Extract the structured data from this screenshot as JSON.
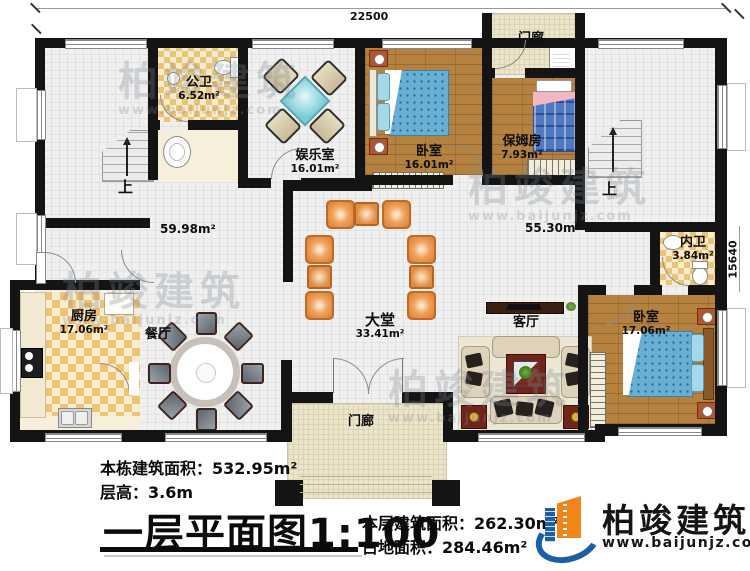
{
  "document": {
    "plan_title": "一层平面图",
    "plan_scale": "1:100",
    "stats": {
      "building_total_label": "本栋建筑面积：",
      "building_total_value": "532.95m²",
      "floor_height_label": "层高：",
      "floor_height_value": "3.6m",
      "floor_area_label": "本层建筑面积：",
      "floor_area_value": "262.30m²",
      "footprint_label": "占地面积：",
      "footprint_value": "284.46m²"
    }
  },
  "dimensions": {
    "top_width": "22500",
    "right_height": "15640"
  },
  "rooms": {
    "gongwei": {
      "name": "公卫",
      "area": "6.52m²"
    },
    "yuleshi": {
      "name": "娱乐室",
      "area": "16.01m²"
    },
    "woshi_top": {
      "name": "卧室",
      "area": "16.01m²"
    },
    "menlang_top": {
      "name": "门廊"
    },
    "baomufang": {
      "name": "保姆房",
      "area": "7.93m²"
    },
    "neiwei": {
      "name": "内卫",
      "area": "3.84m²"
    },
    "chufang": {
      "name": "厨房",
      "area": "17.06m²"
    },
    "canting": {
      "name": "餐厅"
    },
    "datang": {
      "name": "大堂",
      "area": "33.41m²"
    },
    "keting": {
      "name": "客厅"
    },
    "woshi_bottom": {
      "name": "卧室",
      "area": "17.06m²"
    },
    "menlang_bottom": {
      "name": "门廊"
    },
    "hall_open_area": "59.98m²",
    "right_open_area": "55.30m²",
    "stairs_up": "上"
  },
  "branding": {
    "company": "柏竣建筑",
    "website": "www.baijunjz.com"
  },
  "watermark": {
    "text": "柏竣建筑",
    "subtext": "www.baijunjz.com"
  },
  "colors": {
    "wall": "#141414",
    "tile_floor": "#f0f0f0",
    "checker_tan": "#eac377",
    "wood_floor": "#b5813f",
    "porch_floor": "#ece5c9",
    "bed_blue": "#67b0d4",
    "furniture_orange": "#e08b3e",
    "logo_blue": "#1c5fa8",
    "logo_orange": "#f08519"
  }
}
